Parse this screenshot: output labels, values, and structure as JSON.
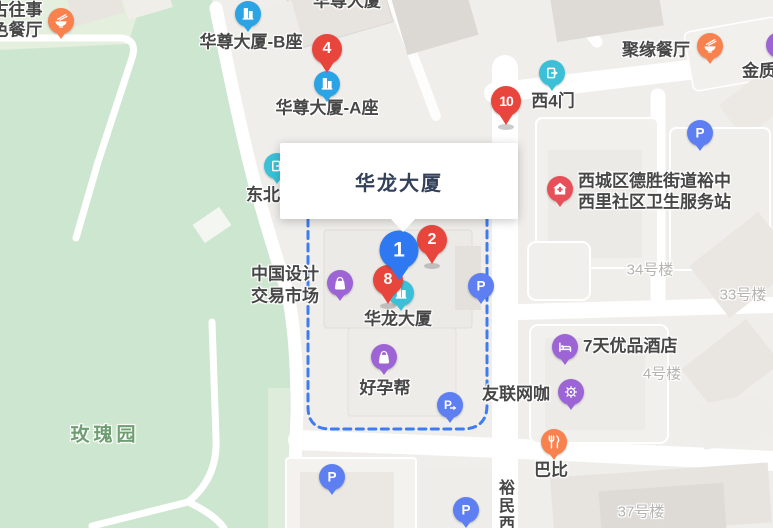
{
  "popup": {
    "title": "华龙大厦"
  },
  "colors": {
    "pin_red": "#e8463d",
    "pin_blue": "#2e78f2",
    "poi_blue": "#2aa4e4",
    "poi_cyan": "#3cc0d8",
    "poi_purple": "#9c64d4",
    "poi_parking_blue": "#5d7ff2",
    "poi_orange": "#f8814e",
    "poi_red": "#e75058",
    "boundary_dash_blue": "#3e7cf2",
    "park_green": "#cde6cf",
    "road_white": "#ffffff"
  },
  "pins": [
    {
      "number": "4",
      "color": "red",
      "size": "md",
      "x": 327,
      "y": 49,
      "shadow": false
    },
    {
      "number": "10",
      "color": "red",
      "size": "md",
      "x": 506,
      "y": 101,
      "shadow": true
    },
    {
      "number": "2",
      "color": "red",
      "size": "md",
      "x": 432,
      "y": 240,
      "shadow": true
    },
    {
      "number": "8",
      "color": "red",
      "size": "md",
      "x": 388,
      "y": 280,
      "shadow": true
    },
    {
      "number": "1",
      "color": "blue",
      "size": "lg",
      "x": 399,
      "y": 250,
      "shadow": false
    }
  ],
  "markers": [
    {
      "icon": "restaurant-icon",
      "color": "orange",
      "x": 61,
      "y": 21
    },
    {
      "icon": "office-building-icon",
      "color": "blue",
      "x": 248,
      "y": 14
    },
    {
      "icon": "office-building-icon",
      "color": "blue",
      "x": 327,
      "y": 84
    },
    {
      "icon": "restaurant-icon",
      "color": "orange",
      "x": 710,
      "y": 46
    },
    {
      "icon": "shopping-icon",
      "color": "purple",
      "x": 779,
      "y": 45
    },
    {
      "icon": "gate-icon",
      "color": "cyan",
      "x": 552,
      "y": 73
    },
    {
      "icon": "gate-icon",
      "color": "cyan",
      "x": 277,
      "y": 166
    },
    {
      "icon": "parking-icon",
      "color": "indigo",
      "x": 700,
      "y": 133
    },
    {
      "icon": "hospital-icon",
      "color": "red",
      "x": 560,
      "y": 189
    },
    {
      "icon": "shopping-icon",
      "color": "purple",
      "x": 340,
      "y": 283
    },
    {
      "icon": "office-building-icon",
      "color": "cyan",
      "x": 401,
      "y": 293
    },
    {
      "icon": "parking-icon",
      "color": "indigo",
      "x": 481,
      "y": 286
    },
    {
      "icon": "shopping-icon",
      "color": "purple",
      "x": 384,
      "y": 357
    },
    {
      "icon": "hotel-icon",
      "color": "purple",
      "x": 565,
      "y": 347
    },
    {
      "icon": "netcafe-icon",
      "color": "purple",
      "x": 571,
      "y": 392
    },
    {
      "icon": "parking-entrance-icon",
      "color": "indigo",
      "x": 450,
      "y": 405
    },
    {
      "icon": "food-icon",
      "color": "orange",
      "x": 554,
      "y": 442
    },
    {
      "icon": "parking-icon",
      "color": "indigo",
      "x": 332,
      "y": 477
    },
    {
      "icon": "parking-icon",
      "color": "indigo",
      "x": 466,
      "y": 510
    }
  ],
  "labels": [
    {
      "text": "古往事",
      "x": 17,
      "y": 10,
      "style": "poi"
    },
    {
      "text": "色餐厅",
      "x": 17,
      "y": 30,
      "style": "poi"
    },
    {
      "text": "华尊大厦",
      "x": 347,
      "y": 1,
      "style": "poi"
    },
    {
      "text": "华尊大厦-B座",
      "x": 251,
      "y": 42,
      "style": "poi"
    },
    {
      "text": "华尊大厦-A座",
      "x": 327,
      "y": 108,
      "style": "poi"
    },
    {
      "text": "聚缘餐厅",
      "x": 656,
      "y": 50,
      "style": "poi"
    },
    {
      "text": "金质",
      "x": 759,
      "y": 71,
      "style": "poi"
    },
    {
      "text": "西4门",
      "x": 553,
      "y": 101,
      "style": "poi"
    },
    {
      "text": "西城区德胜街道裕中",
      "x": 578,
      "y": 181,
      "style": "poi",
      "align": "left"
    },
    {
      "text": "西里社区卫生服务站",
      "x": 578,
      "y": 202,
      "style": "poi",
      "align": "left"
    },
    {
      "text": "东北",
      "x": 263,
      "y": 195,
      "style": "poi"
    },
    {
      "text": "中国设计",
      "x": 285,
      "y": 274,
      "style": "poi"
    },
    {
      "text": "交易市场",
      "x": 285,
      "y": 296,
      "style": "poi"
    },
    {
      "text": "华龙大厦",
      "x": 398,
      "y": 319,
      "style": "poi"
    },
    {
      "text": "好孕帮",
      "x": 385,
      "y": 388,
      "style": "poi"
    },
    {
      "text": "友联网咖",
      "x": 516,
      "y": 394,
      "style": "poi"
    },
    {
      "text": "7天优品酒店",
      "x": 583,
      "y": 346,
      "style": "poi",
      "align": "left"
    },
    {
      "text": "巴比",
      "x": 551,
      "y": 470,
      "style": "poi"
    },
    {
      "text": "34号楼",
      "x": 650,
      "y": 270,
      "style": "bldg"
    },
    {
      "text": "33号楼",
      "x": 743,
      "y": 295,
      "style": "bldg"
    },
    {
      "text": "4号楼",
      "x": 662,
      "y": 374,
      "style": "bldg"
    },
    {
      "text": "37号楼",
      "x": 641,
      "y": 512,
      "style": "bldg"
    },
    {
      "text": "玫瑰园",
      "x": 105,
      "y": 435,
      "style": "park"
    },
    {
      "text": "裕民西",
      "x": 504,
      "y": 479,
      "style": "road-v"
    }
  ]
}
